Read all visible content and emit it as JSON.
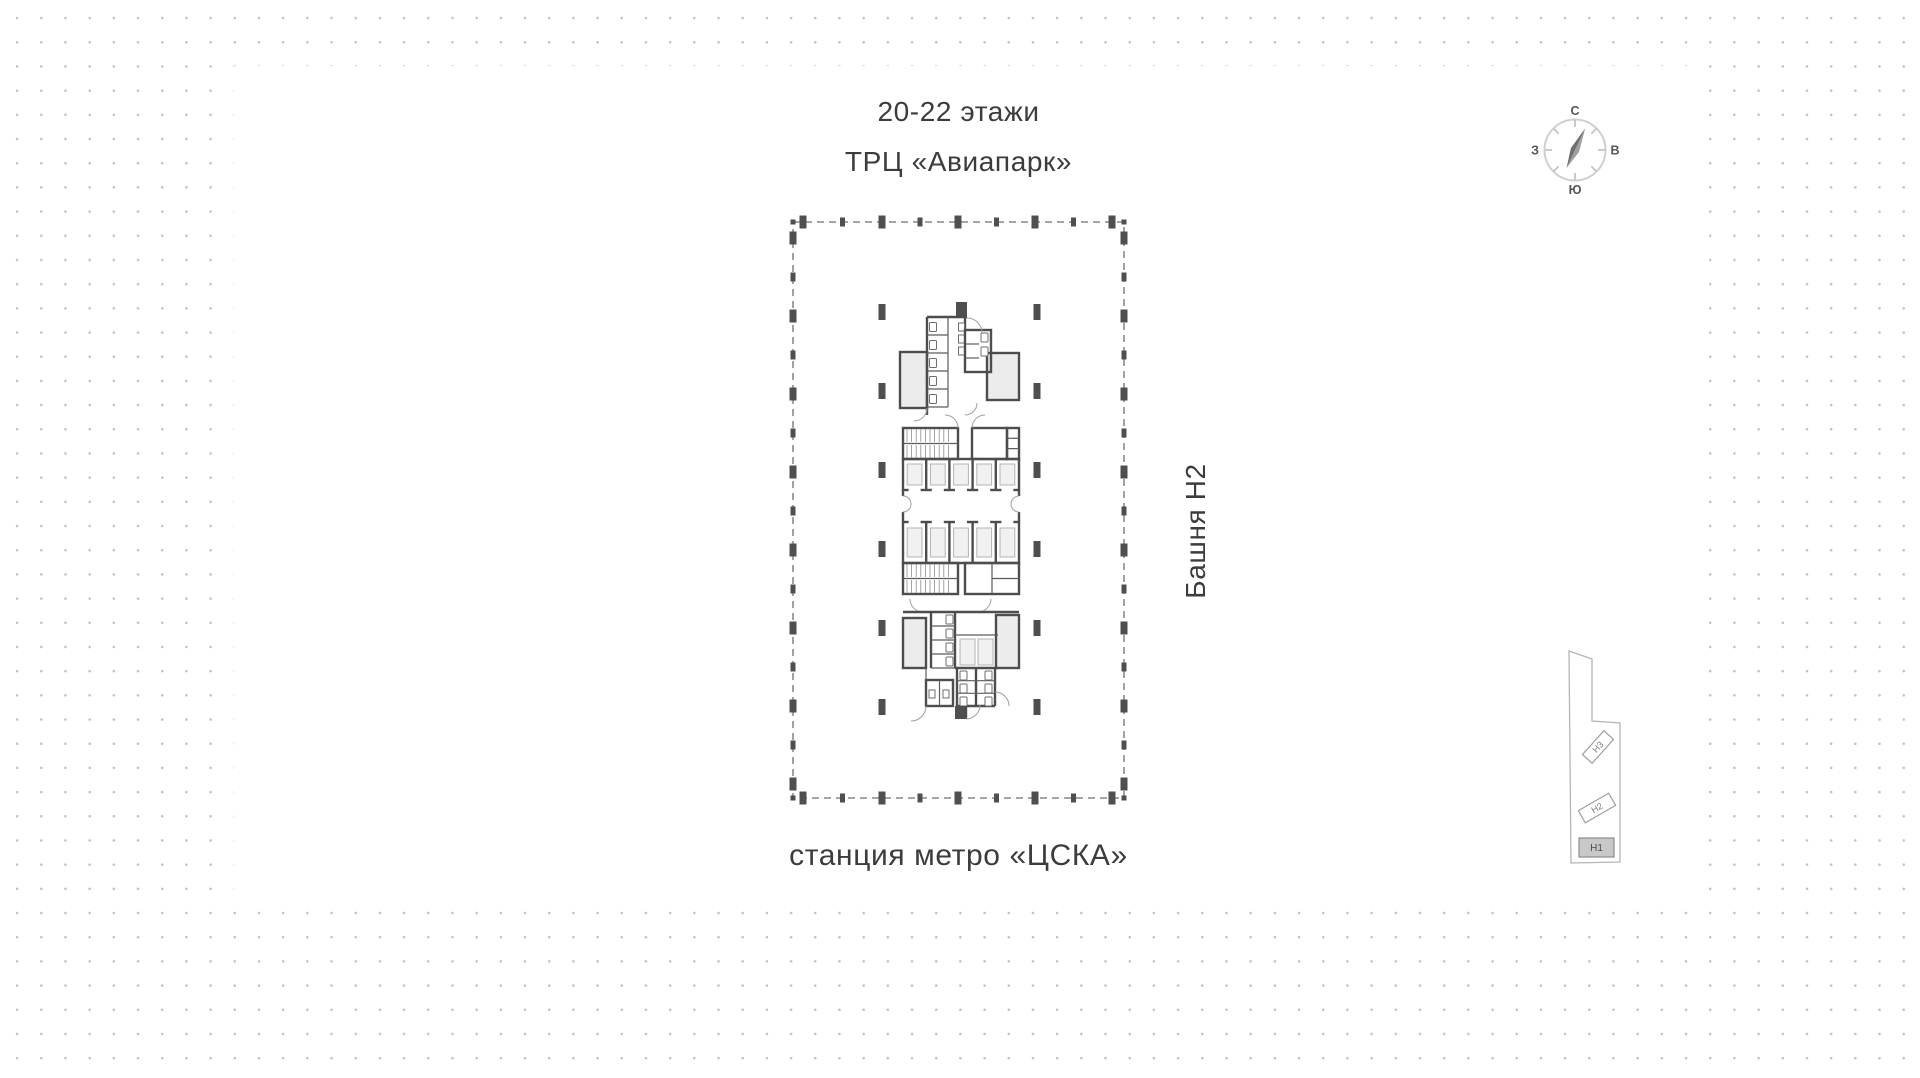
{
  "header": {
    "title_line1": "20-22 этажи",
    "title_line2": "ТРЦ «Авиапарк»"
  },
  "captions": {
    "tower": "Башня Н2",
    "metro": "станция метро «ЦСКА»"
  },
  "compass": {
    "north": "С",
    "east": "В",
    "south": "Ю",
    "west": "З"
  },
  "minimap": {
    "buildings": [
      {
        "label": "Н3",
        "selected": false
      },
      {
        "label": "Н2",
        "selected": false
      },
      {
        "label": "Н1",
        "selected": true
      }
    ]
  },
  "colors": {
    "wall": "#4d4d4d",
    "dashed_outline": "#6f6f6f",
    "room_fill": "#ececec",
    "background_dot": "#c2c2c2",
    "text": "#3c3c3c",
    "selected_building_fill": "#c8c8c8"
  }
}
